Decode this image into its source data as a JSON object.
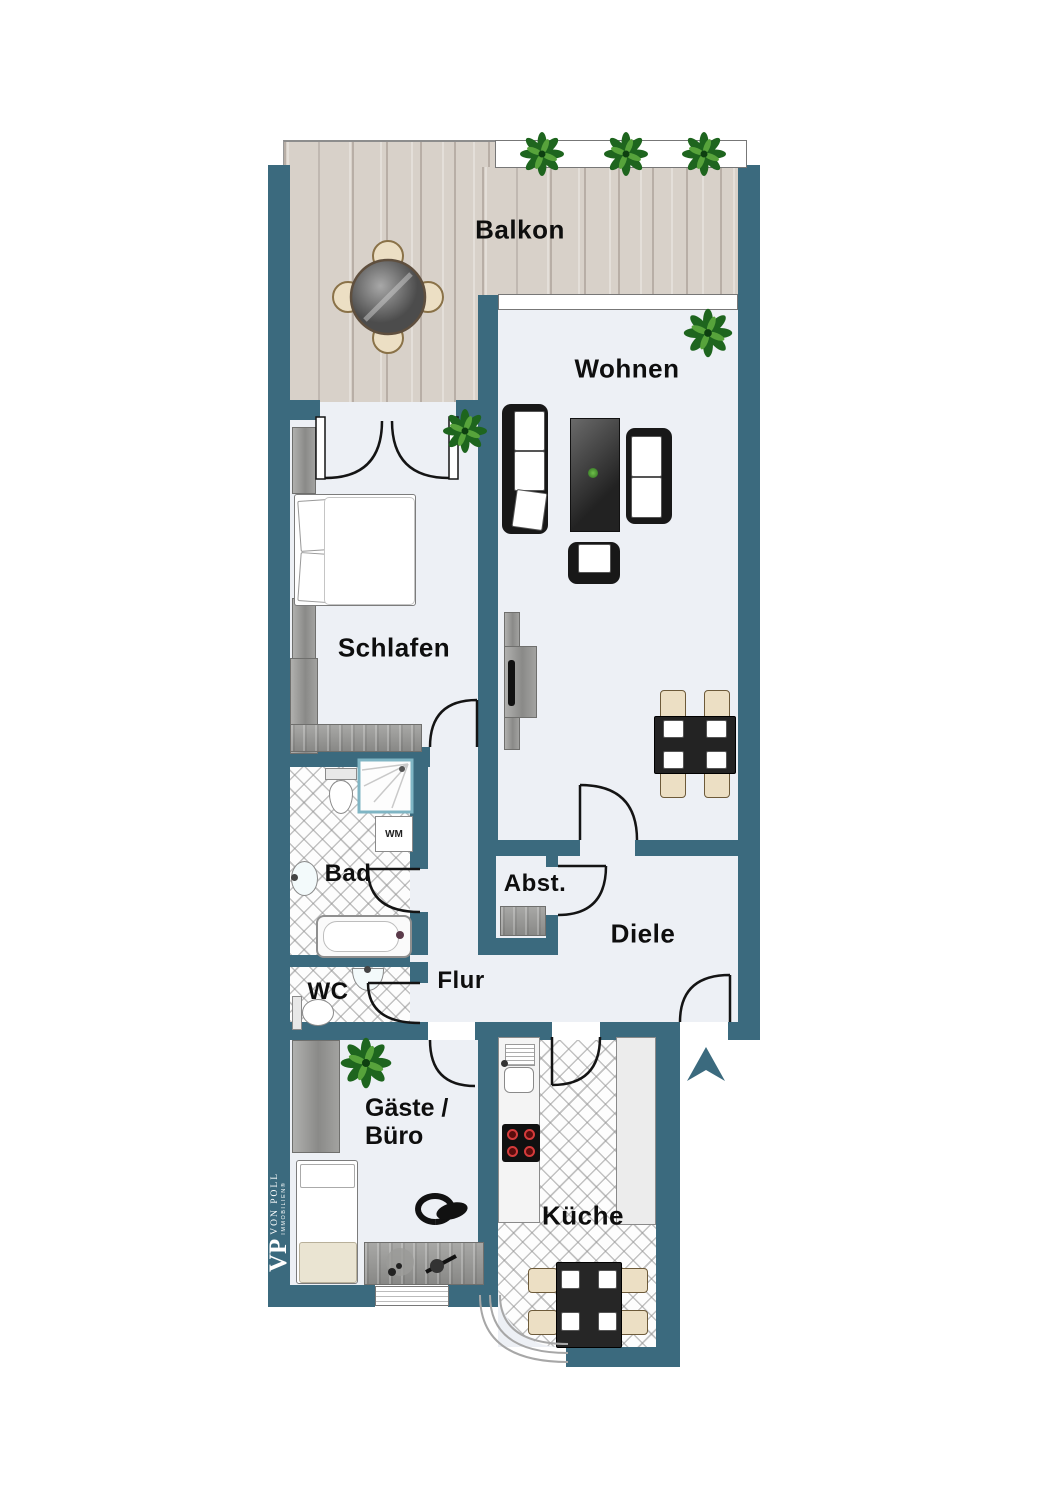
{
  "branding": {
    "monogram": "VP",
    "name": "VON POLL",
    "division": "IMMOBILIEN®"
  },
  "rooms": {
    "balkon": {
      "label": "Balkon"
    },
    "wohnen": {
      "label": "Wohnen"
    },
    "schlafen": {
      "label": "Schlafen"
    },
    "bad": {
      "label": "Bad"
    },
    "wc": {
      "label": "WC"
    },
    "flur": {
      "label": "Flur"
    },
    "abstellraum": {
      "label": "Abst."
    },
    "diele": {
      "label": "Diele"
    },
    "gaeste_buero": {
      "label_line1": "Gäste /",
      "label_line2": "Büro"
    },
    "kueche": {
      "label": "Küche"
    }
  },
  "appliances": {
    "washing_machine": {
      "label": "WM"
    }
  },
  "colors": {
    "wall": "#3b6a7e",
    "floor": "#edf0f5",
    "deck": "#d8d1c9",
    "furniture_dark": "#181818",
    "chair_beige": "#ecdfc4",
    "plant_green": "#1e651e",
    "burner_red": "#d43b3b"
  }
}
